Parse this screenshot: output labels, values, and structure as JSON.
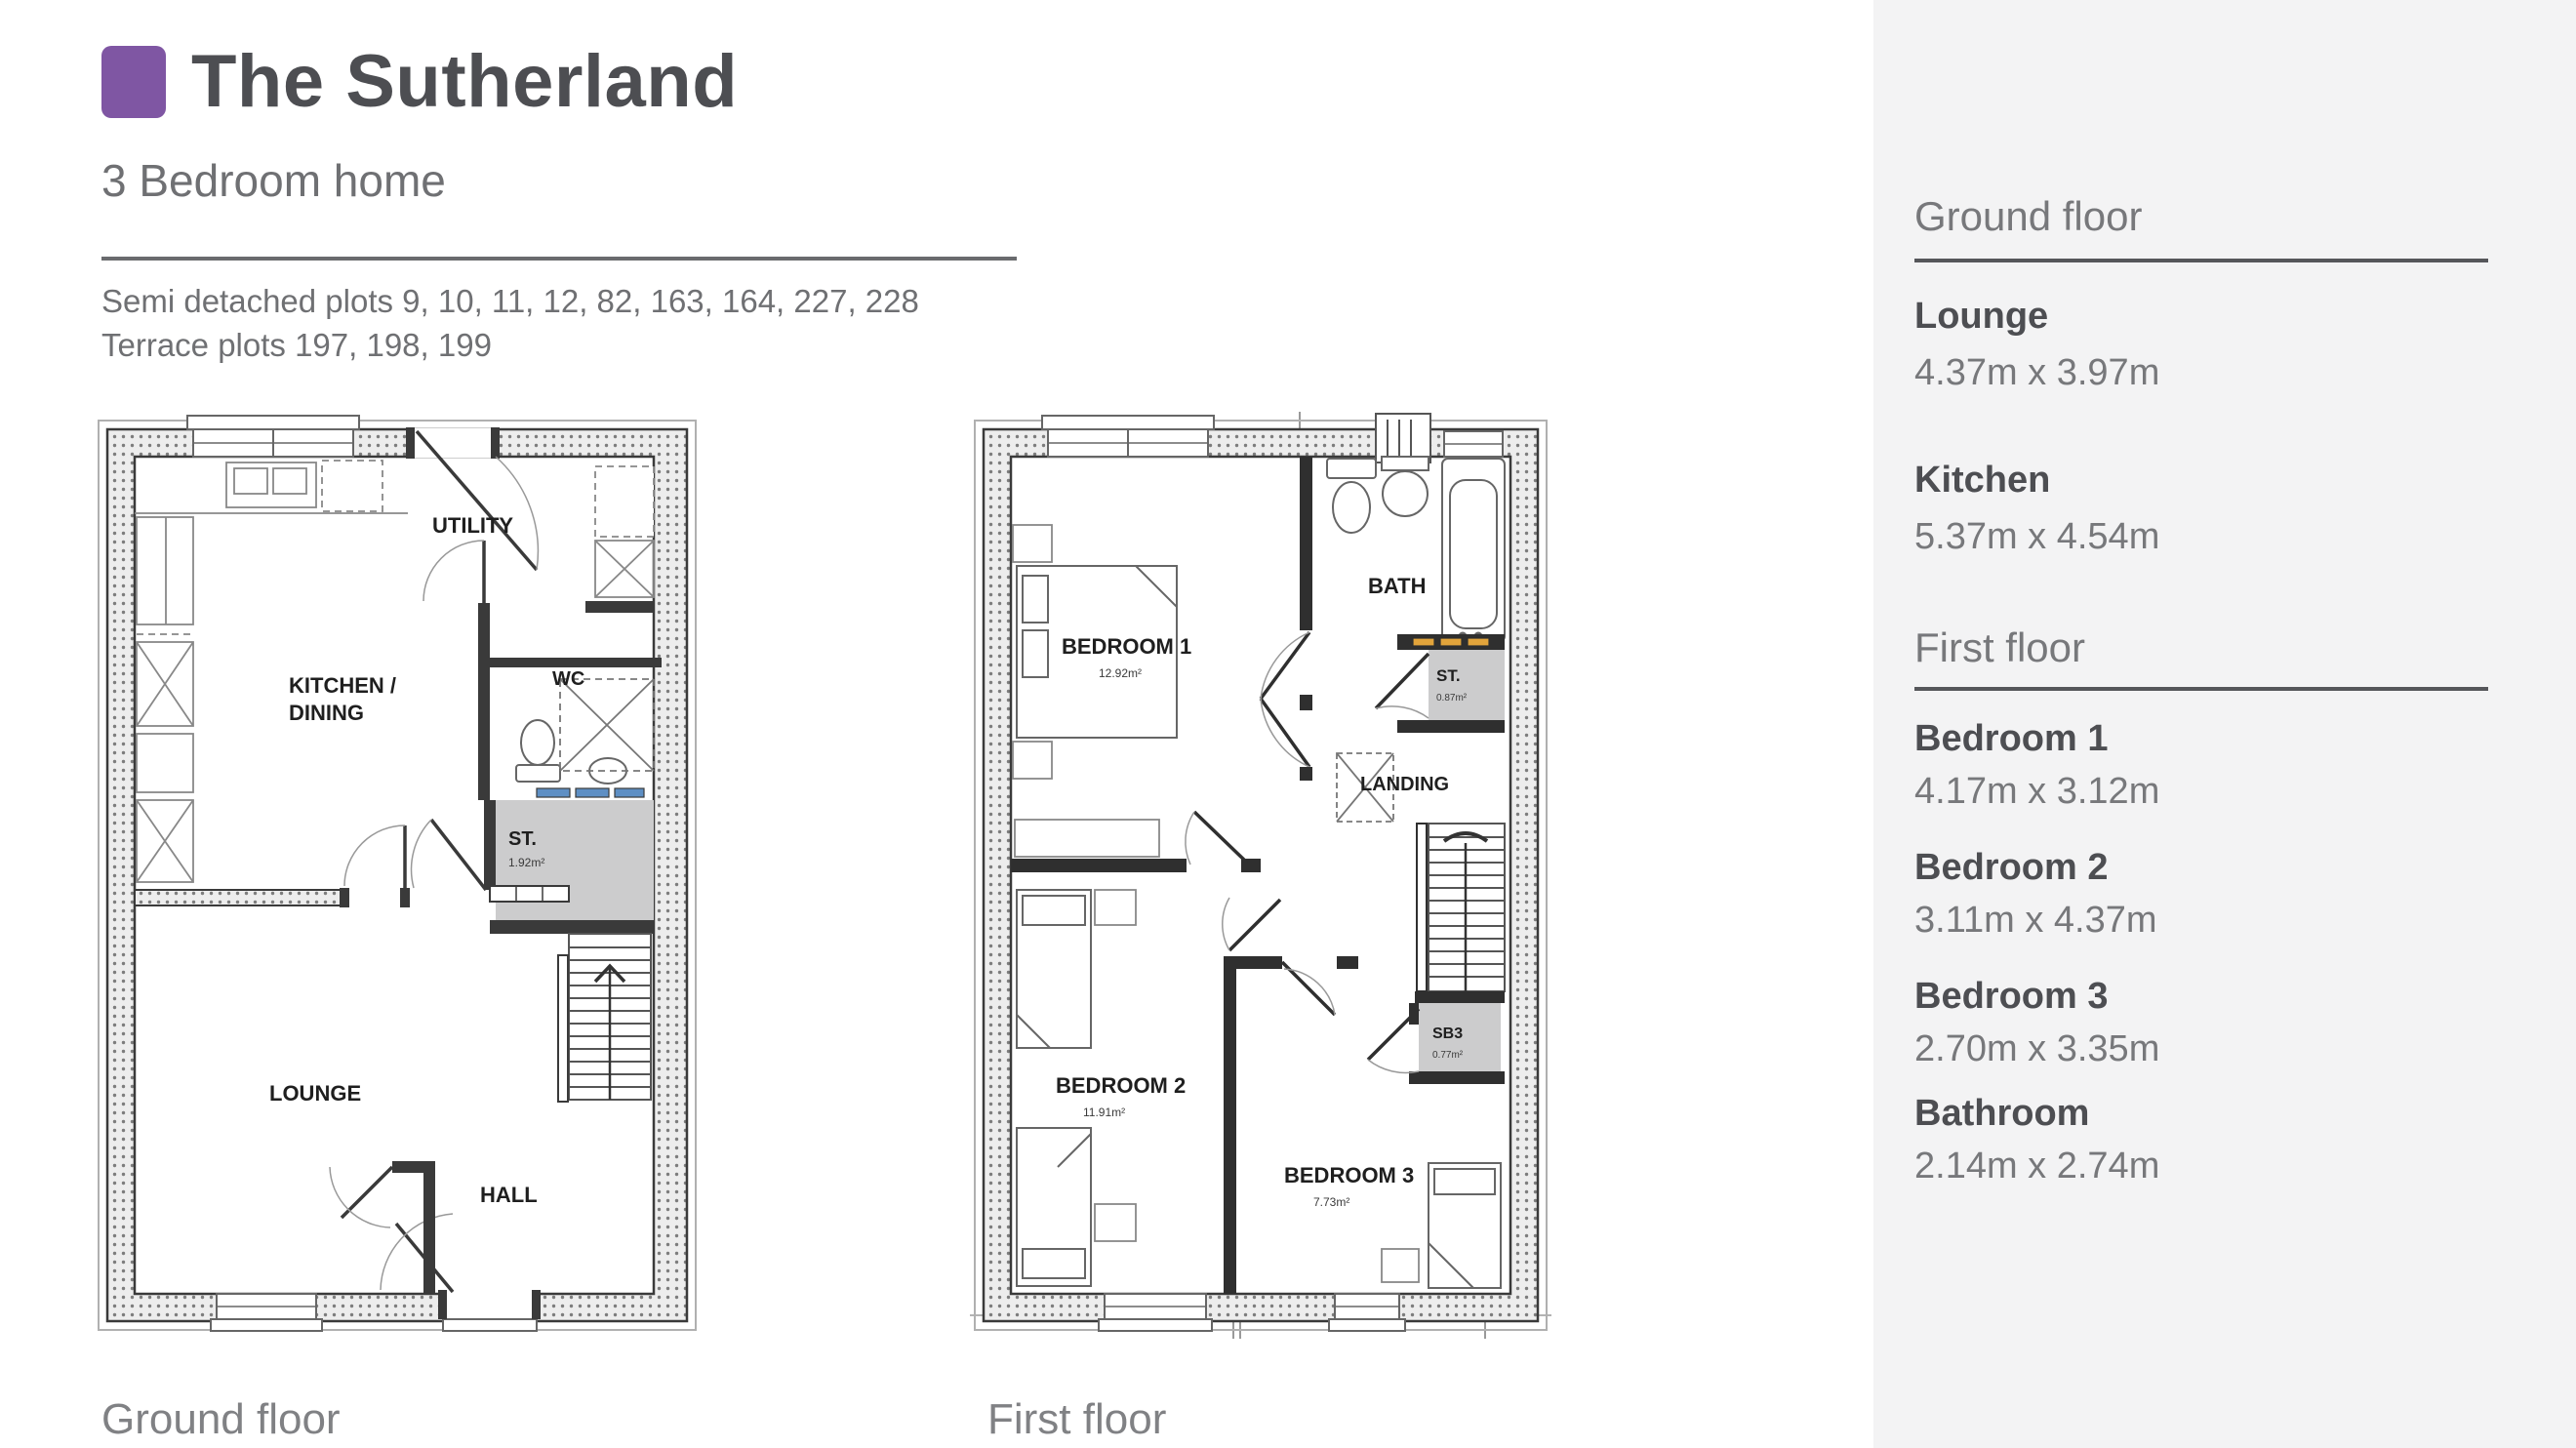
{
  "header": {
    "accent_color": "#7f56a3",
    "title": "The Sutherland",
    "subtitle": "3 Bedroom home",
    "plots_line1": "Semi detached plots 9, 10, 11, 12, 82, 163, 164, 227, 228",
    "plots_line2": "Terrace plots 197, 198, 199"
  },
  "plans": {
    "ground": {
      "caption": "Ground floor",
      "labels": {
        "utility": "UTILITY",
        "kitchen_line1": "KITCHEN /",
        "kitchen_line2": "DINING",
        "wc": "WC",
        "store": "ST.",
        "store_area": "1.92m²",
        "lounge": "LOUNGE",
        "hall": "HALL"
      }
    },
    "first": {
      "caption": "First floor",
      "labels": {
        "bedroom1": "BEDROOM 1",
        "bedroom1_area": "12.92m²",
        "bath": "BATH",
        "store": "ST.",
        "store_area": "0.87m²",
        "landing": "LANDING",
        "bedroom2": "BEDROOM 2",
        "bedroom2_area": "11.91m²",
        "bedroom3": "BEDROOM 3",
        "bedroom3_area": "7.73m²",
        "sb3": "SB3",
        "sb3_area": "0.77m²"
      }
    },
    "colors": {
      "store_fill": "#cccccd",
      "blue_marker": "#5e8fc4",
      "yellow_marker": "#e2a43b"
    }
  },
  "sidebar": {
    "sections": [
      {
        "heading": "Ground floor",
        "rooms": [
          {
            "name": "Lounge",
            "dims": "4.37m x 3.97m"
          },
          {
            "name": "Kitchen",
            "dims": "5.37m x 4.54m"
          }
        ]
      },
      {
        "heading": "First floor",
        "rooms": [
          {
            "name": "Bedroom 1",
            "dims": "4.17m x 3.12m"
          },
          {
            "name": "Bedroom 2",
            "dims": "3.11m x 4.37m"
          },
          {
            "name": "Bedroom 3",
            "dims": "2.70m x 3.35m"
          },
          {
            "name": "Bathroom",
            "dims": "2.14m x 2.74m"
          }
        ]
      }
    ]
  }
}
